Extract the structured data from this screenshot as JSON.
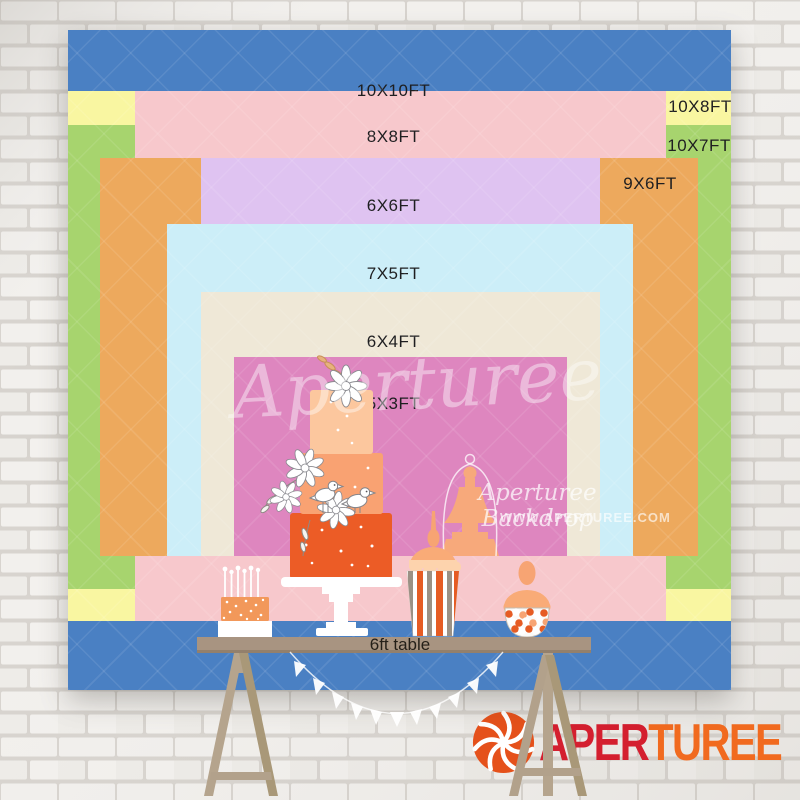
{
  "brand": "Aperturee",
  "size_chart": {
    "description": "nested backdrop size comparison",
    "layers": [
      {
        "label": "10X10FT",
        "color": "#4a80c3"
      },
      {
        "label": "10X8FT",
        "color": "#f9f6a1"
      },
      {
        "label": "10X7FT",
        "color": "#a7d46e"
      },
      {
        "label": "8X8FT",
        "color": "#f7c8cc"
      },
      {
        "label": "9X6FT",
        "color": "#eda95d"
      },
      {
        "label": "6X6FT",
        "color": "#dfc3f1"
      },
      {
        "label": "7X5FT",
        "color": "#cceef8"
      },
      {
        "label": "6X4FT",
        "color": "#efe8d7"
      },
      {
        "label": "5X3FT",
        "color": "#de86bf"
      }
    ]
  },
  "table": {
    "label": "6ft table",
    "surface_color": "#a89481",
    "leg_color": "#b2a18b"
  },
  "watermark": {
    "script_center": "Aperturee",
    "script_right": "Aperturee Backdrop",
    "url": "WWW.APERTUREE.COM",
    "color": "#ffffff"
  },
  "logo": {
    "text_red": "APER",
    "text_orange": "TUREE",
    "red": "#d41f2f",
    "orange": "#f16a1f",
    "icon_color": "#e5511b"
  }
}
